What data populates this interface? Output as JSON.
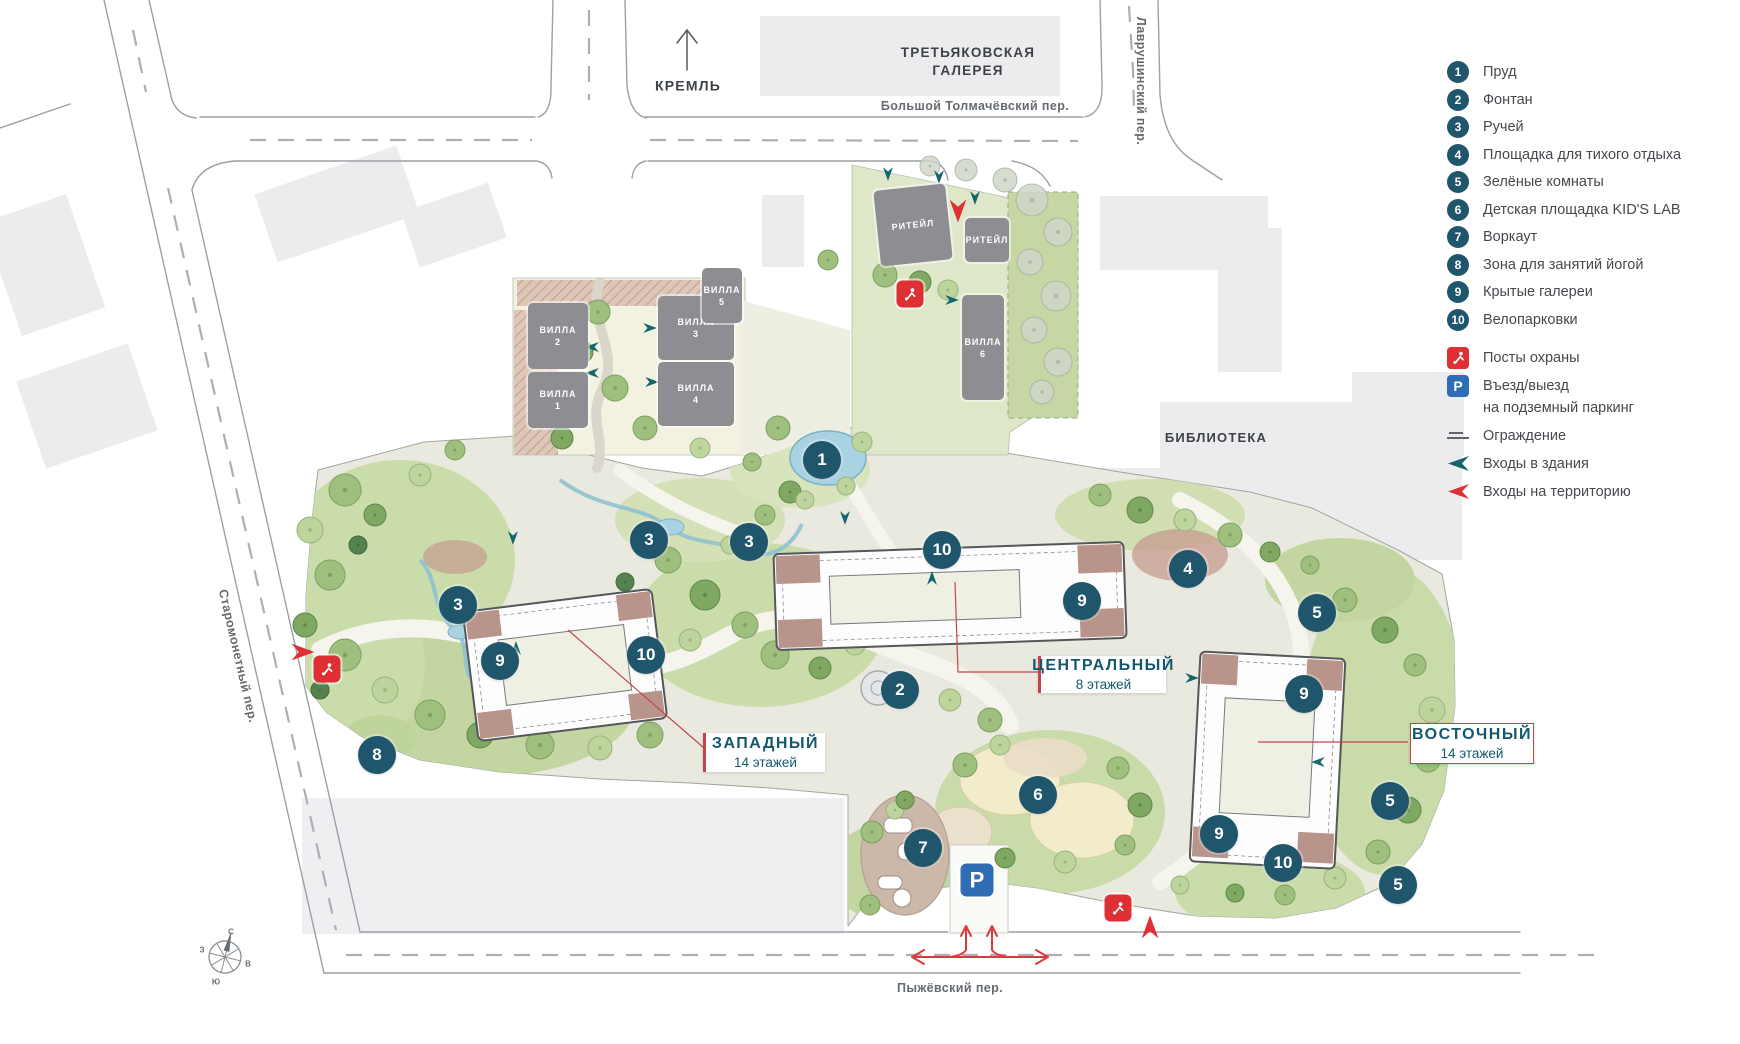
{
  "palette": {
    "marker": "#20566b",
    "accent_red": "#de2f35",
    "parking_blue": "#2f6db5",
    "teal_arrow": "#13656e",
    "text_teal": "#14586e"
  },
  "context": {
    "kremlin_label": "КРЕМЛЬ",
    "gallery_label_line1": "ТРЕТЬЯКОВСКАЯ",
    "gallery_label_line2": "ГАЛЕРЕЯ",
    "library_label": "БИБЛИОТЕКА"
  },
  "streets": {
    "north": "Большой Толмачёвский пер.",
    "east": "Лаврушинский пер.",
    "west": "Старомонетный пер.",
    "south": "Пыжёвский пер."
  },
  "towers": [
    {
      "name": "ЗАПАДНЫЙ",
      "floors": "14 этажей"
    },
    {
      "name": "ЦЕНТРАЛЬНЫЙ",
      "floors": "8 этажей"
    },
    {
      "name": "ВОСТОЧНЫЙ",
      "floors": "14 этажей"
    }
  ],
  "site_buildings": [
    {
      "id": "villa-2",
      "line1": "ВИЛЛА",
      "line2": "2",
      "x": 528,
      "y": 303,
      "w": 60,
      "h": 66,
      "rot": 0
    },
    {
      "id": "villa-1",
      "line1": "ВИЛЛА",
      "line2": "1",
      "x": 528,
      "y": 372,
      "w": 60,
      "h": 56,
      "rot": 0
    },
    {
      "id": "villa-3",
      "line1": "ВИЛЛА",
      "line2": "3",
      "x": 658,
      "y": 296,
      "w": 76,
      "h": 64,
      "rot": 0
    },
    {
      "id": "villa-4",
      "line1": "ВИЛЛА",
      "line2": "4",
      "x": 658,
      "y": 362,
      "w": 76,
      "h": 64,
      "rot": 0
    },
    {
      "id": "villa-5",
      "line1": "ВИЛЛА",
      "line2": "5",
      "x": 702,
      "y": 268,
      "w": 40,
      "h": 55,
      "rot": 0
    },
    {
      "id": "villa-6",
      "line1": "ВИЛЛА",
      "line2": "6",
      "x": 962,
      "y": 295,
      "w": 42,
      "h": 105,
      "rot": 0
    },
    {
      "id": "retail-1",
      "line1": "РИТЕЙЛ",
      "line2": "",
      "x": 877,
      "y": 187,
      "w": 72,
      "h": 76,
      "rot": -6
    },
    {
      "id": "retail-2",
      "line1": "РИТЕЙЛ",
      "line2": "",
      "x": 965,
      "y": 218,
      "w": 44,
      "h": 44,
      "rot": 0
    }
  ],
  "markers": [
    {
      "n": "1",
      "x": 822,
      "y": 460
    },
    {
      "n": "3",
      "x": 649,
      "y": 540
    },
    {
      "n": "3",
      "x": 749,
      "y": 542
    },
    {
      "n": "3",
      "x": 458,
      "y": 605
    },
    {
      "n": "10",
      "x": 942,
      "y": 550
    },
    {
      "n": "9",
      "x": 1082,
      "y": 601
    },
    {
      "n": "4",
      "x": 1188,
      "y": 569
    },
    {
      "n": "5",
      "x": 1317,
      "y": 613
    },
    {
      "n": "9",
      "x": 500,
      "y": 661
    },
    {
      "n": "10",
      "x": 646,
      "y": 655
    },
    {
      "n": "2",
      "x": 900,
      "y": 690
    },
    {
      "n": "8",
      "x": 377,
      "y": 755
    },
    {
      "n": "6",
      "x": 1038,
      "y": 795
    },
    {
      "n": "7",
      "x": 923,
      "y": 848
    },
    {
      "n": "9",
      "x": 1304,
      "y": 694
    },
    {
      "n": "9",
      "x": 1219,
      "y": 834
    },
    {
      "n": "10",
      "x": 1283,
      "y": 863
    },
    {
      "n": "5",
      "x": 1390,
      "y": 801
    },
    {
      "n": "5",
      "x": 1398,
      "y": 885
    }
  ],
  "map_icons": [
    {
      "type": "guard",
      "x": 910,
      "y": 294
    },
    {
      "type": "guard",
      "x": 327,
      "y": 669
    },
    {
      "type": "guard",
      "x": 1118,
      "y": 908
    },
    {
      "type": "parking",
      "x": 977,
      "y": 880,
      "label": "P"
    }
  ],
  "legend": {
    "items": [
      {
        "n": "1",
        "label": "Пруд"
      },
      {
        "n": "2",
        "label": "Фонтан"
      },
      {
        "n": "3",
        "label": "Ручей"
      },
      {
        "n": "4",
        "label": "Площадка для тихого отдыха"
      },
      {
        "n": "5",
        "label": "Зелёные комнаты"
      },
      {
        "n": "6",
        "label": "Детская площадка KID'S LAB"
      },
      {
        "n": "7",
        "label": "Воркаут"
      },
      {
        "n": "8",
        "label": "Зона для занятий йогой"
      },
      {
        "n": "9",
        "label": "Крытые галереи"
      },
      {
        "n": "10",
        "label": "Велопарковки"
      }
    ],
    "symbols": [
      {
        "type": "guard",
        "label": "Посты охраны"
      },
      {
        "type": "parking",
        "icon_label": "P",
        "label": "Въезд/выезд",
        "label2": "на подземный паркинг"
      },
      {
        "type": "fence",
        "label": "Ограждение"
      },
      {
        "type": "entry-building",
        "label": "Входы в здания"
      },
      {
        "type": "entry-territory",
        "label": "Входы на территорию"
      }
    ]
  },
  "compass": {
    "n": "С",
    "s": "Ю",
    "w": "З",
    "e": "В"
  }
}
